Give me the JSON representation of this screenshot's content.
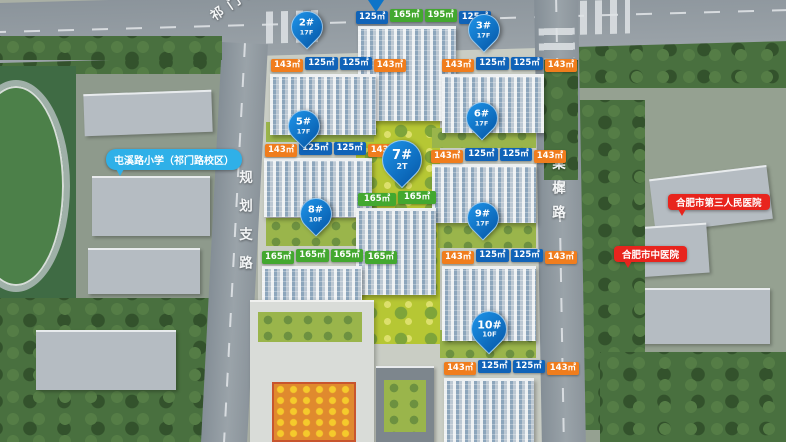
{
  "roads": {
    "top": "祁门路",
    "left": "规划支路",
    "right": "棠樨路"
  },
  "pois": {
    "school": "屯溪路小学（祁门路校区）",
    "hospital_third": "合肥市第三人民医院",
    "hospital_tcm": "合肥市中医院"
  },
  "pins": {
    "p2": {
      "no": "2#",
      "floors": "17F"
    },
    "p3": {
      "no": "3#",
      "floors": "17F"
    },
    "p5": {
      "no": "5#",
      "floors": "17F"
    },
    "p6": {
      "no": "6#",
      "floors": "17F"
    },
    "p7": {
      "no": "7#",
      "floors": "2T"
    },
    "p8": {
      "no": "8#",
      "floors": "10F"
    },
    "p9": {
      "no": "9#",
      "floors": "17F"
    },
    "p10": {
      "no": "10#",
      "floors": "10F"
    }
  },
  "unit_rows": {
    "b4": [
      "125㎡",
      "165㎡",
      "195㎡",
      "125㎡"
    ],
    "b2": [
      "143㎡",
      "125㎡",
      "125㎡",
      "143㎡"
    ],
    "b3": [
      "143㎡",
      "125㎡",
      "125㎡",
      "143㎡"
    ],
    "b5": [
      "143㎡",
      "125㎡",
      "125㎡",
      "143㎡"
    ],
    "b6": [
      "143㎡",
      "125㎡",
      "125㎡",
      "143㎡"
    ],
    "b7": [
      "165㎡",
      "165㎡"
    ],
    "b8": [
      "165㎡",
      "165㎡",
      "165㎡",
      "165㎡"
    ],
    "b9": [
      "143㎡",
      "125㎡",
      "125㎡",
      "143㎡"
    ],
    "b10": [
      "143㎡",
      "125㎡",
      "125㎡",
      "143㎡"
    ]
  },
  "colors": {
    "pin_blue": "#0d74c8",
    "chip_blue": "#1063b8",
    "chip_orange": "#f07d1d",
    "chip_green": "#43a82f",
    "poi_red": "#e8241d",
    "poi_blue": "#2fb0e8"
  }
}
